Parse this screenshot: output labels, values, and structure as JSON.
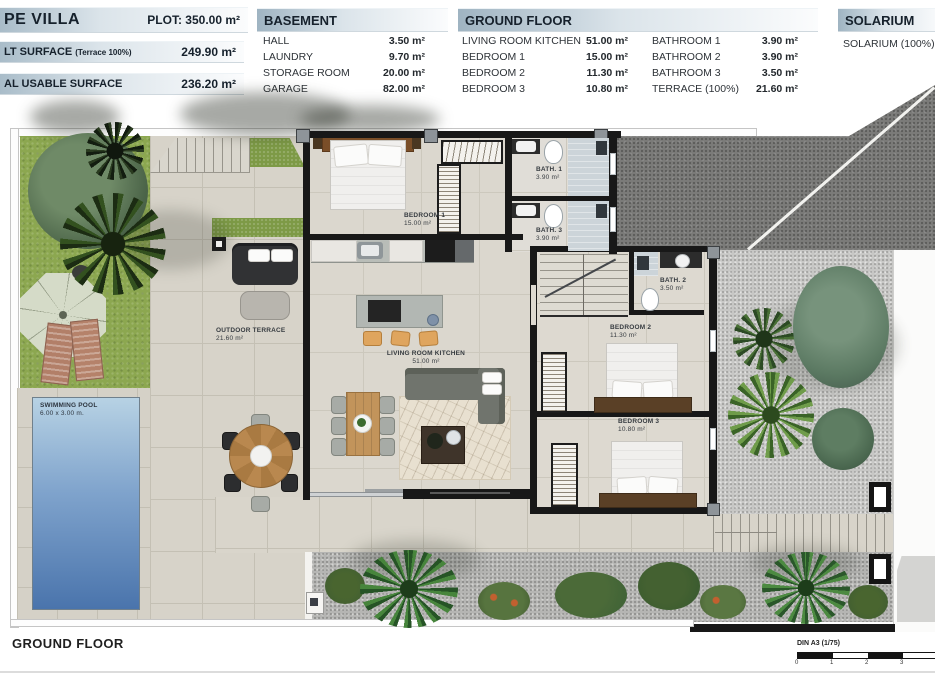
{
  "header": {
    "title": {
      "name": "PE VILLA",
      "plot": "PLOT: 350.00 m²"
    },
    "surfaces": [
      {
        "label": "LT SURFACE",
        "note": "(Terrace 100%)",
        "value": "249.90 m²"
      },
      {
        "label": "AL USABLE SURFACE",
        "note": "",
        "value": "236.20 m²"
      }
    ],
    "basement": {
      "title": "BASEMENT",
      "items": [
        {
          "label": "HALL",
          "value": "3.50 m²"
        },
        {
          "label": "LAUNDRY",
          "value": "9.70 m²"
        },
        {
          "label": "STORAGE ROOM",
          "value": "20.00 m²"
        },
        {
          "label": "GARAGE",
          "value": "82.00 m²"
        }
      ]
    },
    "ground_floor": {
      "title": "GROUND FLOOR",
      "col1": [
        {
          "label": "LIVING ROOM KITCHEN",
          "value": "51.00 m²"
        },
        {
          "label": "BEDROOM 1",
          "value": "15.00 m²"
        },
        {
          "label": "BEDROOM 2",
          "value": "11.30 m²"
        },
        {
          "label": "BEDROOM 3",
          "value": "10.80 m²"
        }
      ],
      "col2": [
        {
          "label": "BATHROOM 1",
          "value": "3.90 m²"
        },
        {
          "label": "BATHROOM 2",
          "value": "3.90 m²"
        },
        {
          "label": "BATHROOM 3",
          "value": "3.50 m²"
        },
        {
          "label": "TERRACE (100%)",
          "value": "21.60 m²"
        }
      ]
    },
    "solarium": {
      "title": "SOLARIUM",
      "item": "SOLARIUM (100%)"
    }
  },
  "plan": {
    "labels": {
      "bedroom1": {
        "name": "BEDROOM 1",
        "area": "15.00 m²"
      },
      "bedroom2": {
        "name": "BEDROOM 2",
        "area": "11.30 m²"
      },
      "bedroom3": {
        "name": "BEDROOM 3",
        "area": "10.80 m²"
      },
      "bath1": {
        "name": "BATH. 1",
        "area": "3.90 m²"
      },
      "bath2": {
        "name": "BATH. 2",
        "area": "3.50 m²"
      },
      "bath3": {
        "name": "BATH. 3",
        "area": "3.90 m²"
      },
      "living": {
        "name": "LIVING ROOM KITCHEN",
        "area": "51.00 m²"
      },
      "terrace": {
        "name": "OUTDOOR TERRACE",
        "area": "21.60 m²"
      },
      "pool": {
        "name": "SWIMMING POOL",
        "area": "6.00 x 3.00 m."
      }
    },
    "footer": {
      "floor_label": "GROUND FLOOR",
      "scale_label": "DIN A3 (1/75)",
      "ticks": [
        "0",
        "1",
        "2",
        "3"
      ]
    }
  },
  "colors": {
    "header_gradient_start": "#9fb4c2",
    "wall": "#181818",
    "grass": "#8ca750",
    "pool_top": "#b7d2e4",
    "pool_bottom": "#4a74ac",
    "driveway": "#7b7b79"
  }
}
